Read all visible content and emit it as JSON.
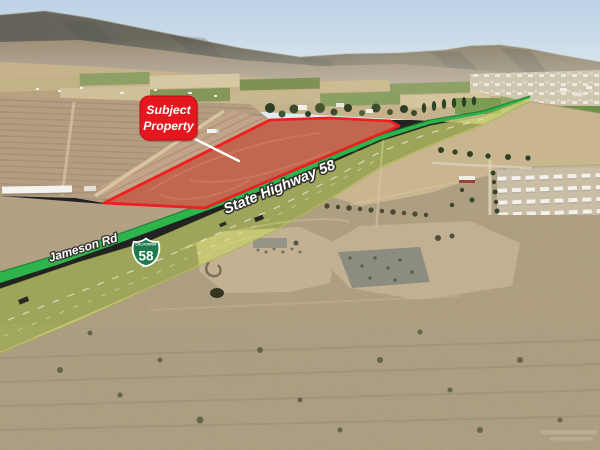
{
  "callout": {
    "line1": "Subject",
    "line2": "Property"
  },
  "labels": {
    "highway": "State Highway 58",
    "frontage_road": "Jameson Rd"
  },
  "shield": {
    "state": "CALIFORNIA",
    "route": "58"
  },
  "colors": {
    "callout_red": "#e6161e",
    "property_outline": "#ee1f22",
    "property_fill": "#d03420",
    "highway_overlay": "#d9e26a",
    "frontage_road_green": "#2db44b",
    "shield_green": "#1c7a4d",
    "label_text": "#ffffff"
  }
}
